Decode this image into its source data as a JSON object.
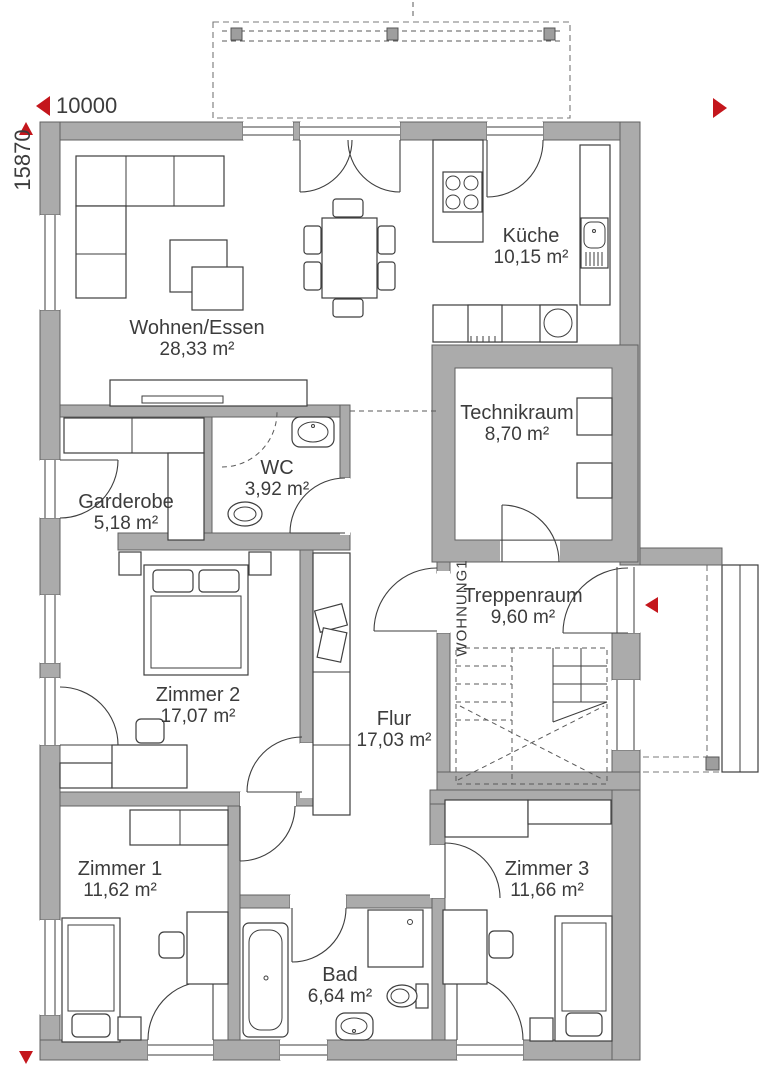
{
  "meta": {
    "wall_color": "#ababab",
    "accent_red": "#c4161c",
    "line_color": "#3e3e3e"
  },
  "dimensions": {
    "width_label": "10000",
    "height_label": "15870"
  },
  "unit_label": "WOHNUNG1",
  "rooms": [
    {
      "id": "wohnen-essen",
      "name": "Wohnen/Essen",
      "area": "28,33 m²"
    },
    {
      "id": "kueche",
      "name": "Küche",
      "area": "10,15 m²"
    },
    {
      "id": "technikraum",
      "name": "Technikraum",
      "area": "8,70 m²"
    },
    {
      "id": "wc",
      "name": "WC",
      "area": "3,92 m²"
    },
    {
      "id": "garderobe",
      "name": "Garderobe",
      "area": "5,18 m²"
    },
    {
      "id": "zimmer2",
      "name": "Zimmer 2",
      "area": "17,07 m²"
    },
    {
      "id": "treppenraum",
      "name": "Treppenraum",
      "area": "9,60 m²"
    },
    {
      "id": "flur",
      "name": "Flur",
      "area": "17,03 m²"
    },
    {
      "id": "zimmer1",
      "name": "Zimmer 1",
      "area": "11,62 m²"
    },
    {
      "id": "zimmer3",
      "name": "Zimmer 3",
      "area": "11,66 m²"
    },
    {
      "id": "bad",
      "name": "Bad",
      "area": "6,64 m²"
    }
  ]
}
